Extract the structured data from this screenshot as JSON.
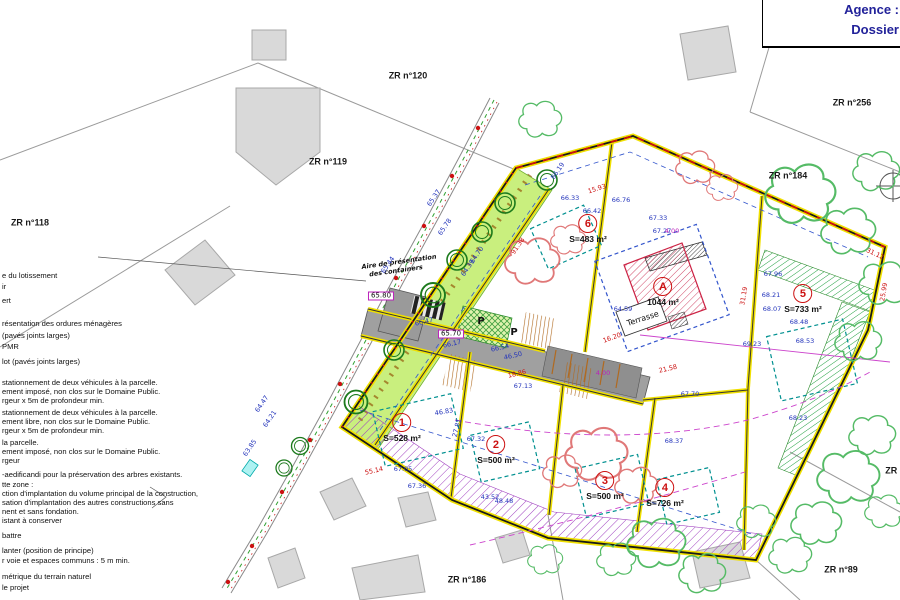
{
  "palette": {
    "lot_line_yellow": "#f0e000",
    "boundary_red": "#cc1111",
    "road_gray": "#a0a0a0",
    "green_strip": "#c9ef7e",
    "hatch_purple": "#a040c0",
    "hatch_pink": "#d04868",
    "tree_green": "#2e8b2e",
    "text_blue": "#2233bb",
    "title_navy": "#22229a"
  },
  "title_block": {
    "agence": "Agence :",
    "dossier": "Dossier"
  },
  "zr_labels": [
    {
      "text": "ZR n°120",
      "x": 408,
      "y": 76
    },
    {
      "text": "ZR n°119",
      "x": 328,
      "y": 162
    },
    {
      "text": "ZR n°118",
      "x": 30,
      "y": 223
    },
    {
      "text": "ZR n°256",
      "x": 852,
      "y": 103
    },
    {
      "text": "ZR n°184",
      "x": 788,
      "y": 176
    },
    {
      "text": "ZR n°186",
      "x": 467,
      "y": 580
    },
    {
      "text": "ZR n°89",
      "x": 841,
      "y": 570
    },
    {
      "text": "ZR n°",
      "x": 897,
      "y": 471
    }
  ],
  "lots": [
    {
      "num": "1",
      "area": "S=528 m²",
      "x": 402,
      "y": 428
    },
    {
      "num": "2",
      "area": "S=500 m²",
      "x": 496,
      "y": 450
    },
    {
      "num": "3",
      "area": "S=500 m²",
      "x": 605,
      "y": 486
    },
    {
      "num": "4",
      "area": "S=726 m²",
      "x": 665,
      "y": 493
    },
    {
      "num": "5",
      "area": "S=733 m²",
      "x": 803,
      "y": 299
    },
    {
      "num": "6",
      "area": "S=483 m²",
      "x": 588,
      "y": 229
    },
    {
      "num": "A",
      "area": "1044 m²",
      "x": 663,
      "y": 292
    }
  ],
  "plan_labels": [
    {
      "text": "Terrasse",
      "x": 643,
      "y": 319,
      "rot": -18,
      "cls": "terrasse"
    },
    {
      "text": "Aire de présentation",
      "x": 399,
      "y": 262,
      "rot": -8,
      "cls": "note"
    },
    {
      "text": "des containers",
      "x": 396,
      "y": 271,
      "rot": -8,
      "cls": "note"
    },
    {
      "text": "P",
      "x": 481,
      "y": 322,
      "cls": "plabel"
    },
    {
      "text": "P",
      "x": 514,
      "y": 333,
      "cls": "plabel"
    },
    {
      "text": "65.80",
      "x": 381,
      "y": 296,
      "cls": "boxed"
    },
    {
      "text": "65.70",
      "x": 451,
      "y": 334,
      "cls": "boxed"
    }
  ],
  "legend": [
    {
      "text": "e du lotissement",
      "x": 2,
      "y": 276
    },
    {
      "text": "ir",
      "x": 2,
      "y": 287
    },
    {
      "text": "ert",
      "x": 2,
      "y": 301
    },
    {
      "text": "résentation des ordures ménagères",
      "x": 2,
      "y": 324
    },
    {
      "text": "(pavés joints larges)",
      "x": 2,
      "y": 336
    },
    {
      "text": "PMR",
      "x": 2,
      "y": 347
    },
    {
      "text": "lot (pavés joints larges)",
      "x": 2,
      "y": 362
    },
    {
      "text": "stationnement de deux véhicules à la parcelle.",
      "x": 2,
      "y": 383
    },
    {
      "text": "ement imposé, non clos sur le Domaine Public.",
      "x": 2,
      "y": 392
    },
    {
      "text": "rgeur x 5m de profondeur min.",
      "x": 2,
      "y": 401
    },
    {
      "text": "stationnement de deux véhicules à la parcelle.",
      "x": 2,
      "y": 413
    },
    {
      "text": "ement libre, non clos sur le Domaine Public.",
      "x": 2,
      "y": 422
    },
    {
      "text": "rgeur x 5m de profondeur min.",
      "x": 2,
      "y": 431
    },
    {
      "text": "la parcelle.",
      "x": 2,
      "y": 443
    },
    {
      "text": "ement imposé, non clos sur le Domaine Public.",
      "x": 2,
      "y": 452
    },
    {
      "text": "rgeur",
      "x": 2,
      "y": 461
    },
    {
      "text": "-aedificandi pour la préservation des arbres existants.",
      "x": 2,
      "y": 475
    },
    {
      "text": "tte zone :",
      "x": 2,
      "y": 485
    },
    {
      "text": "ction d'implantation du volume principal de la construction,",
      "x": 2,
      "y": 494
    },
    {
      "text": "sation d'implantation des autres constructions sans",
      "x": 2,
      "y": 503
    },
    {
      "text": "nent et sans fondation.",
      "x": 2,
      "y": 512
    },
    {
      "text": "istant à conserver",
      "x": 2,
      "y": 521
    },
    {
      "text": "battre",
      "x": 2,
      "y": 536
    },
    {
      "text": "lanter (position de principe)",
      "x": 2,
      "y": 551
    },
    {
      "text": "r voie et espaces communs : 5 m min.",
      "x": 2,
      "y": 561
    },
    {
      "text": "métrique du terrain naturel",
      "x": 2,
      "y": 577
    },
    {
      "text": "le projet",
      "x": 2,
      "y": 588
    }
  ],
  "measurements": [
    {
      "text": "66.33",
      "x": 570,
      "y": 198,
      "color": "blue"
    },
    {
      "text": "66.42",
      "x": 592,
      "y": 211,
      "color": "blue"
    },
    {
      "text": "66.76",
      "x": 621,
      "y": 200,
      "color": "blue"
    },
    {
      "text": "67.33",
      "x": 658,
      "y": 218,
      "color": "blue"
    },
    {
      "text": "67.27",
      "x": 662,
      "y": 231,
      "color": "blue"
    },
    {
      "text": "46.83",
      "x": 444,
      "y": 412,
      "color": "blue",
      "rot": -10
    },
    {
      "text": "27.81",
      "x": 457,
      "y": 428,
      "color": "blue",
      "rot": -76
    },
    {
      "text": "67.05",
      "x": 403,
      "y": 469,
      "color": "blue"
    },
    {
      "text": "67.36",
      "x": 417,
      "y": 486,
      "color": "blue"
    },
    {
      "text": "67.32",
      "x": 476,
      "y": 439,
      "color": "blue"
    },
    {
      "text": "43.52",
      "x": 490,
      "y": 497,
      "color": "blue"
    },
    {
      "text": "48.48",
      "x": 504,
      "y": 501,
      "color": "blue"
    },
    {
      "text": "68.37",
      "x": 674,
      "y": 441,
      "color": "blue"
    },
    {
      "text": "67.96",
      "x": 773,
      "y": 274,
      "color": "blue"
    },
    {
      "text": "68.21",
      "x": 771,
      "y": 295,
      "color": "blue"
    },
    {
      "text": "68.07",
      "x": 772,
      "y": 309,
      "color": "blue"
    },
    {
      "text": "68.48",
      "x": 799,
      "y": 322,
      "color": "blue"
    },
    {
      "text": "68.53",
      "x": 805,
      "y": 341,
      "color": "blue"
    },
    {
      "text": "69.23",
      "x": 752,
      "y": 344,
      "color": "blue"
    },
    {
      "text": "68.23",
      "x": 798,
      "y": 418,
      "color": "blue"
    },
    {
      "text": "66.47",
      "x": 424,
      "y": 322,
      "color": "blue",
      "rot": -13
    },
    {
      "text": "66.17",
      "x": 452,
      "y": 344,
      "color": "blue",
      "rot": -13
    },
    {
      "text": "66.54",
      "x": 500,
      "y": 348,
      "color": "blue",
      "rot": -13
    },
    {
      "text": "46.50",
      "x": 513,
      "y": 356,
      "color": "blue",
      "rot": -13
    },
    {
      "text": "67.13",
      "x": 523,
      "y": 386,
      "color": "blue"
    },
    {
      "text": "67.70",
      "x": 690,
      "y": 394,
      "color": "blue"
    },
    {
      "text": "64.59",
      "x": 623,
      "y": 309,
      "color": "blue"
    },
    {
      "text": "65.44",
      "x": 388,
      "y": 265,
      "color": "blue",
      "rot": -56
    },
    {
      "text": "65.37",
      "x": 434,
      "y": 198,
      "color": "blue",
      "rot": -56
    },
    {
      "text": "65.78",
      "x": 445,
      "y": 227,
      "color": "blue",
      "rot": -56
    },
    {
      "text": "66.19",
      "x": 558,
      "y": 171,
      "color": "blue",
      "rot": -56
    },
    {
      "text": "64.39",
      "x": 468,
      "y": 268,
      "color": "blue",
      "rot": -56
    },
    {
      "text": "64.70",
      "x": 477,
      "y": 255,
      "color": "blue",
      "rot": -56
    },
    {
      "text": "64.47",
      "x": 262,
      "y": 404,
      "color": "blue",
      "rot": -56
    },
    {
      "text": "64.21",
      "x": 270,
      "y": 419,
      "color": "blue",
      "rot": -56
    },
    {
      "text": "63.85",
      "x": 250,
      "y": 448,
      "color": "blue",
      "rot": -56
    },
    {
      "text": "55.14",
      "x": 374,
      "y": 471,
      "color": "red",
      "rot": -13
    },
    {
      "text": "21.58",
      "x": 668,
      "y": 369,
      "color": "red",
      "rot": -13
    },
    {
      "text": "15.93",
      "x": 597,
      "y": 189,
      "color": "red",
      "rot": -18
    },
    {
      "text": "91.38",
      "x": 518,
      "y": 246,
      "color": "red",
      "rot": -56
    },
    {
      "text": "31.19",
      "x": 744,
      "y": 296,
      "color": "red",
      "rot": -80
    },
    {
      "text": "31.12",
      "x": 875,
      "y": 254,
      "color": "red",
      "rot": 25
    },
    {
      "text": "25.99",
      "x": 884,
      "y": 292,
      "color": "red",
      "rot": -80
    },
    {
      "text": "16.20",
      "x": 612,
      "y": 338,
      "color": "red",
      "rot": -20
    },
    {
      "text": "18.86",
      "x": 517,
      "y": 374,
      "color": "red",
      "rot": -13
    },
    {
      "text": "4.00",
      "x": 672,
      "y": 231,
      "color": "magenta"
    },
    {
      "text": "4.00",
      "x": 603,
      "y": 373,
      "color": "magenta"
    }
  ]
}
